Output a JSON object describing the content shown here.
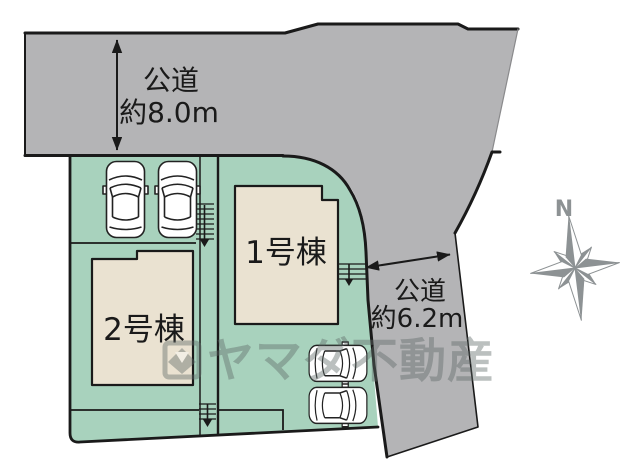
{
  "diagram": {
    "type": "real-estate-site-plan",
    "roads": {
      "top": {
        "name": "公道",
        "width_label": "約8.0m"
      },
      "right": {
        "name": "公道",
        "width_label": "約6.2m"
      }
    },
    "buildings": [
      {
        "label": "1号棟"
      },
      {
        "label": "2号棟"
      }
    ],
    "compass": {
      "north": "N"
    },
    "watermark": {
      "text": "ヤマダ不動産"
    },
    "colors": {
      "road": "#b4b4b6",
      "plot": "#a8d2bd",
      "building": "#eae2d1",
      "outline": "#1a1a1a",
      "watermark": "#5f6a68",
      "compass": "#8d9294"
    }
  }
}
